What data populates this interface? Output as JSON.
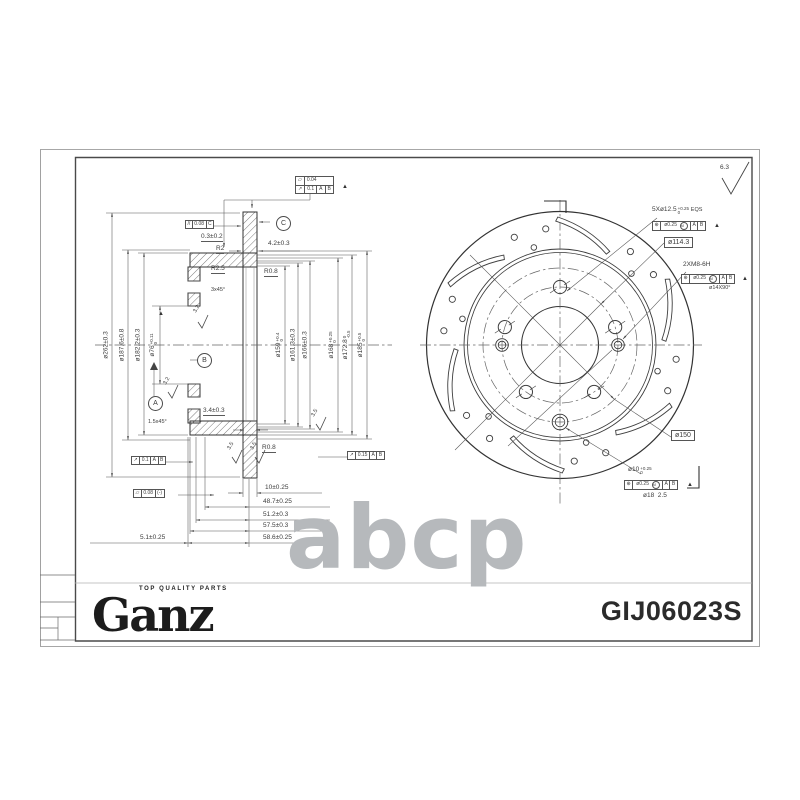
{
  "sheet": {
    "brand": "Ganz",
    "tagline": "TOP QUALITY PARTS",
    "part_number": "GIJ06023S",
    "watermark": "abcp"
  },
  "datum": {
    "a": "A",
    "b": "B",
    "c": "C"
  },
  "sym": {
    "flatness": "▱",
    "runout": "↗",
    "parallel": "//",
    "position": "⊕",
    "tri": "▲"
  },
  "gdt": {
    "flatness_top": "0.04",
    "runout_top": "0.1",
    "parallelism": "0.08",
    "runout_left": "0.1",
    "flatness_bottom": "0.08",
    "flatness_bottom_note": "(-)",
    "runout_right": "0.15",
    "pos_tol": "ø0.25",
    "mmc": "M"
  },
  "left_view": {
    "offset": "0.3±0.2",
    "r2": "R2",
    "disc_thk": "4.2±0.3",
    "r25": "R2.5",
    "r08_top": "R0.8",
    "chamfer_top": "3x45°",
    "rough_32": "3.2",
    "rough_35": "3.5",
    "hat_thk": "3.4±0.3",
    "chamfer_bot": "1.5x45°",
    "r08_bot": "R0.8",
    "chain": [
      "10±0.25",
      "48.7±0.25",
      "51.2±0.3",
      "57.5±0.3",
      "58.6±0.25"
    ],
    "chain_left": "5.1±0.25",
    "dia_left": [
      {
        "t": "ø262±0.3",
        "up": "",
        "dn": ""
      },
      {
        "t": "ø187.6±0.8",
        "up": "",
        "dn": ""
      },
      {
        "t": "ø182.2±0.3",
        "up": "",
        "dn": ""
      },
      {
        "t": "ø76",
        "up": "+0.11",
        "dn": "0"
      }
    ],
    "dia_mid": [
      {
        "t": "ø159",
        "up": "+0.4",
        "dn": "0"
      },
      {
        "t": "ø161.3±0.3",
        "up": "",
        "dn": ""
      },
      {
        "t": "ø166±0.3",
        "up": "",
        "dn": ""
      },
      {
        "t": "ø168",
        "up": "+0.25",
        "dn": "0"
      },
      {
        "t": "ø172.8",
        "up": "0",
        "dn": "-0.5"
      },
      {
        "t": "ø185",
        "up": "+0.5",
        "dn": "0"
      }
    ]
  },
  "right_view": {
    "rough_general": "6.3",
    "holes": {
      "t": "5Xø12.5",
      "up": "+0.25",
      "dn": "0",
      "eqs": "EQS"
    },
    "pcd": "ø114.3",
    "thread": "2XM8-6H",
    "csink": "ø14X90°",
    "c150": "ø150",
    "pin": {
      "t": "ø10",
      "up": "+0.25",
      "dn": "0"
    },
    "pin_note": "ø18  2.5"
  }
}
